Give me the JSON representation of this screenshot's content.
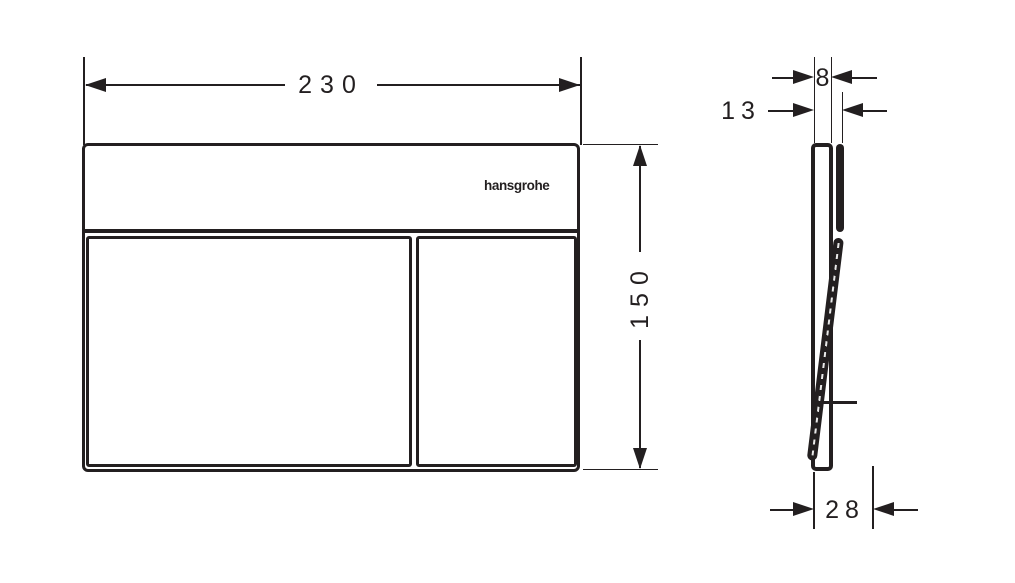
{
  "drawing": {
    "kind": "flush-plate dimensional drawing",
    "views": [
      "front",
      "side"
    ]
  },
  "front_view": {
    "width_label": "230",
    "height_label": "150",
    "logo_text": "hansgrohe"
  },
  "side_view": {
    "plate_depth_label": "8",
    "total_depth_label": "13",
    "open_depth_label": "28"
  },
  "colors": {
    "ink": "#231f20",
    "background": "#ffffff"
  }
}
